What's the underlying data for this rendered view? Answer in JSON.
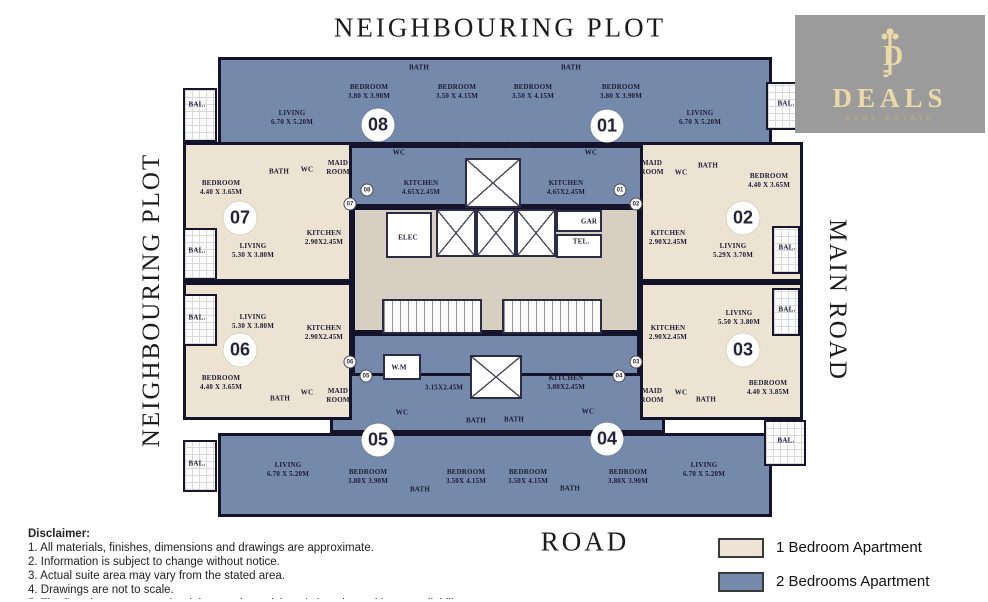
{
  "surroundings": {
    "top": "NEIGHBOURING PLOT",
    "left": "NEIGHBOURING PLOT",
    "right": "MAIN ROAD",
    "bottom": "ROAD"
  },
  "logo": {
    "monogram": "D",
    "name": "DEALS",
    "subtitle": "REAL ESTATE",
    "bg": "#9b9b9b",
    "gold": "#ecd9a8"
  },
  "legend": {
    "items": [
      {
        "label": "1 Bedroom Apartment",
        "color": "#ece3d2"
      },
      {
        "label": "2 Bedrooms Apartment",
        "color": "#7589ab"
      }
    ]
  },
  "disclaimer": {
    "title": "Disclaimer:",
    "lines": [
      "1. All materials, finishes, dimensions and drawings are approximate.",
      "2. Information is subject to change without notice.",
      "3. Actual suite area may vary from the stated area.",
      "4. Drawings are not to scale.",
      "5. The Developer reserves the right to make revisions / alterations without any liability whatsoever."
    ]
  },
  "plan": {
    "colors": {
      "two_bed": "#7589ab",
      "one_bed": "#ece3d2",
      "core": "#d8cfc3",
      "wall": "#13132b"
    },
    "unit_circles": [
      {
        "n": "08",
        "x": 378,
        "y": 125
      },
      {
        "n": "01",
        "x": 607,
        "y": 126
      },
      {
        "n": "07",
        "x": 240,
        "y": 218
      },
      {
        "n": "02",
        "x": 743,
        "y": 218
      },
      {
        "n": "06",
        "x": 240,
        "y": 350
      },
      {
        "n": "03",
        "x": 743,
        "y": 350
      },
      {
        "n": "05",
        "x": 378,
        "y": 440
      },
      {
        "n": "04",
        "x": 607,
        "y": 439
      }
    ],
    "entry_markers": [
      {
        "n": "08",
        "x": 367,
        "y": 190
      },
      {
        "n": "07",
        "x": 350,
        "y": 204
      },
      {
        "n": "01",
        "x": 620,
        "y": 190
      },
      {
        "n": "02",
        "x": 636,
        "y": 204
      },
      {
        "n": "06",
        "x": 350,
        "y": 362
      },
      {
        "n": "05",
        "x": 366,
        "y": 376
      },
      {
        "n": "03",
        "x": 636,
        "y": 362
      },
      {
        "n": "04",
        "x": 619,
        "y": 376
      }
    ],
    "labels": [
      {
        "lines": [
          "LIVING",
          "6.70 X 5.20M"
        ],
        "x": 292,
        "y": 118
      },
      {
        "lines": [
          "BEDROOM",
          "3.80 X 3.90M"
        ],
        "x": 369,
        "y": 92
      },
      {
        "lines": [
          "BATH"
        ],
        "x": 419,
        "y": 68
      },
      {
        "lines": [
          "BEDROOM",
          "3.50 X 4.15M"
        ],
        "x": 457,
        "y": 92
      },
      {
        "lines": [
          "BATH"
        ],
        "x": 470,
        "y": 146
      },
      {
        "lines": [
          "WC"
        ],
        "x": 399,
        "y": 153
      },
      {
        "lines": [
          "MAID",
          "ROOM"
        ],
        "x": 338,
        "y": 168
      },
      {
        "lines": [
          "BEDROOM",
          "3.50 X 4.15M"
        ],
        "x": 533,
        "y": 92
      },
      {
        "lines": [
          "BATH"
        ],
        "x": 571,
        "y": 68
      },
      {
        "lines": [
          "BEDROOM",
          "3.80 X 3.90M"
        ],
        "x": 621,
        "y": 92
      },
      {
        "lines": [
          "LIVING",
          "6.70 X 5.20M"
        ],
        "x": 700,
        "y": 118
      },
      {
        "lines": [
          "BATH"
        ],
        "x": 520,
        "y": 146
      },
      {
        "lines": [
          "WC"
        ],
        "x": 591,
        "y": 153
      },
      {
        "lines": [
          "MAID",
          "ROOM"
        ],
        "x": 652,
        "y": 168
      },
      {
        "lines": [
          "KITCHEN",
          "4.65X2.45M"
        ],
        "x": 421,
        "y": 188
      },
      {
        "lines": [
          "KITCHEN",
          "4.65X2.45M"
        ],
        "x": 566,
        "y": 188
      },
      {
        "lines": [
          "ELEC"
        ],
        "x": 408,
        "y": 238
      },
      {
        "lines": [
          "GAR"
        ],
        "x": 589,
        "y": 222
      },
      {
        "lines": [
          "TEL."
        ],
        "x": 581,
        "y": 242
      },
      {
        "lines": [
          "BEDROOM",
          "4.40 X 3.65M"
        ],
        "x": 221,
        "y": 188
      },
      {
        "lines": [
          "BATH"
        ],
        "x": 279,
        "y": 172
      },
      {
        "lines": [
          "WC"
        ],
        "x": 307,
        "y": 170
      },
      {
        "lines": [
          "LIVING",
          "5.30 X 3.80M"
        ],
        "x": 253,
        "y": 251
      },
      {
        "lines": [
          "KITCHEN",
          "2.90X2.45M"
        ],
        "x": 324,
        "y": 238
      },
      {
        "lines": [
          "WC"
        ],
        "x": 681,
        "y": 173
      },
      {
        "lines": [
          "BATH"
        ],
        "x": 708,
        "y": 166
      },
      {
        "lines": [
          "BEDROOM",
          "4.40 X 3.65M"
        ],
        "x": 769,
        "y": 181
      },
      {
        "lines": [
          "KITCHEN",
          "2.90X2.45M"
        ],
        "x": 668,
        "y": 238
      },
      {
        "lines": [
          "LIVING",
          "5.29X 3.70M"
        ],
        "x": 733,
        "y": 251
      },
      {
        "lines": [
          "LIVING",
          "5.30 X 3.80M"
        ],
        "x": 253,
        "y": 322
      },
      {
        "lines": [
          "KITCHEN",
          "2.90X2.45M"
        ],
        "x": 324,
        "y": 333
      },
      {
        "lines": [
          "BEDROOM",
          "4.40 X 3.65M"
        ],
        "x": 221,
        "y": 383
      },
      {
        "lines": [
          "BATH"
        ],
        "x": 280,
        "y": 399
      },
      {
        "lines": [
          "WC"
        ],
        "x": 307,
        "y": 393
      },
      {
        "lines": [
          "KITCHEN",
          "2.90X2.45M"
        ],
        "x": 668,
        "y": 333
      },
      {
        "lines": [
          "LIVING",
          "5.50 X 3.80M"
        ],
        "x": 739,
        "y": 318
      },
      {
        "lines": [
          "BEDROOM",
          "4.40 X 3.85M"
        ],
        "x": 768,
        "y": 388
      },
      {
        "lines": [
          "BATH"
        ],
        "x": 706,
        "y": 400
      },
      {
        "lines": [
          "WC"
        ],
        "x": 681,
        "y": 393
      },
      {
        "lines": [
          "W.M"
        ],
        "x": 399,
        "y": 368
      },
      {
        "lines": [
          "3.15X2.45M"
        ],
        "x": 444,
        "y": 388
      },
      {
        "lines": [
          "KITCHEN",
          "3.80X2.45M"
        ],
        "x": 566,
        "y": 383
      },
      {
        "lines": [
          "WC"
        ],
        "x": 402,
        "y": 413
      },
      {
        "lines": [
          "BATH"
        ],
        "x": 476,
        "y": 421
      },
      {
        "lines": [
          "BATH"
        ],
        "x": 514,
        "y": 420
      },
      {
        "lines": [
          "WC"
        ],
        "x": 588,
        "y": 412
      },
      {
        "lines": [
          "MAID",
          "ROOM"
        ],
        "x": 338,
        "y": 396
      },
      {
        "lines": [
          "LIVING",
          "6.70 X 5.20M"
        ],
        "x": 288,
        "y": 470
      },
      {
        "lines": [
          "BEDROOM",
          "3.80X 3.90M"
        ],
        "x": 368,
        "y": 477
      },
      {
        "lines": [
          "BATH"
        ],
        "x": 420,
        "y": 490
      },
      {
        "lines": [
          "BEDROOM",
          "3.50X 4.15M"
        ],
        "x": 466,
        "y": 477
      },
      {
        "lines": [
          "MAID",
          "ROOM"
        ],
        "x": 652,
        "y": 396
      },
      {
        "lines": [
          "BEDROOM",
          "3.50X 4.15M"
        ],
        "x": 528,
        "y": 477
      },
      {
        "lines": [
          "BATH"
        ],
        "x": 570,
        "y": 489
      },
      {
        "lines": [
          "BEDROOM",
          "3.80X 3.90M"
        ],
        "x": 628,
        "y": 477
      },
      {
        "lines": [
          "LIVING",
          "6.70 X 5.20M"
        ],
        "x": 704,
        "y": 470
      },
      {
        "lines": [
          "BAL."
        ],
        "x": 197,
        "y": 105
      },
      {
        "lines": [
          "BAL."
        ],
        "x": 197,
        "y": 251
      },
      {
        "lines": [
          "BAL."
        ],
        "x": 197,
        "y": 318
      },
      {
        "lines": [
          "BAL."
        ],
        "x": 197,
        "y": 464
      },
      {
        "lines": [
          "BAL."
        ],
        "x": 786,
        "y": 104
      },
      {
        "lines": [
          "BAL."
        ],
        "x": 787,
        "y": 248
      },
      {
        "lines": [
          "BAL."
        ],
        "x": 787,
        "y": 310
      },
      {
        "lines": [
          "BAL."
        ],
        "x": 786,
        "y": 441
      }
    ]
  }
}
